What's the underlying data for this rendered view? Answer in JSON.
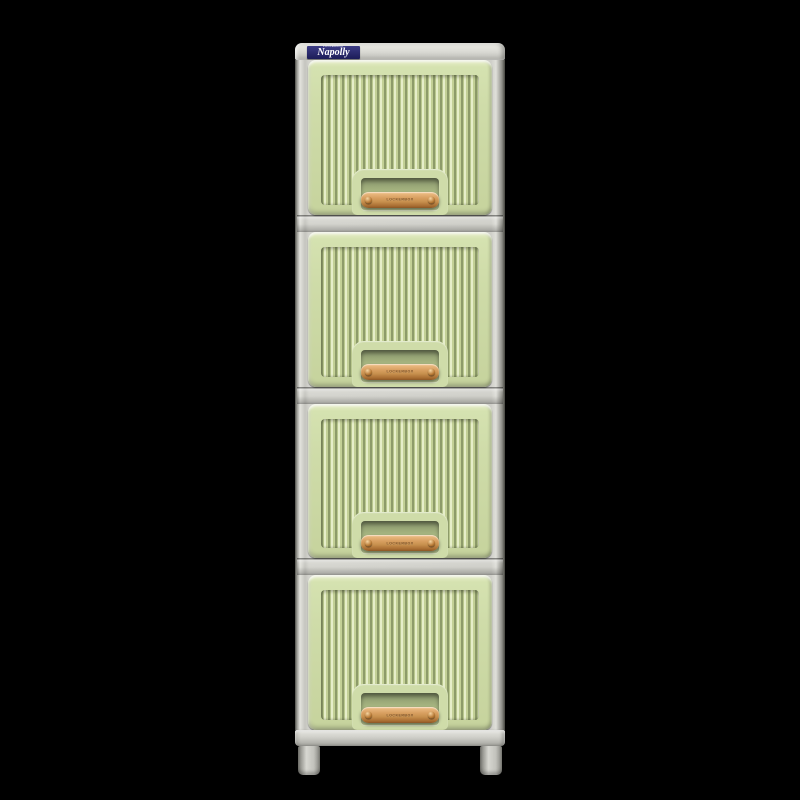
{
  "scene": {
    "background_color": "#000000",
    "subject": "Napolly four-drawer plastic stacking storage cabinet product photo"
  },
  "cabinet": {
    "brand_label": {
      "sub_text": "LOCKERBOX",
      "brand_text": "Napolly",
      "bg_color": "#23236b",
      "text_color": "#ffffff"
    },
    "drawer_count": 4,
    "drawers": [
      {
        "id": "drawer-1",
        "handle_engraving": "LOCKERBOX"
      },
      {
        "id": "drawer-2",
        "handle_engraving": "LOCKERBOX"
      },
      {
        "id": "drawer-3",
        "handle_engraving": "LOCKERBOX"
      },
      {
        "id": "drawer-4",
        "handle_engraving": "LOCKERBOX"
      }
    ],
    "colors": {
      "panel_green": "#cfdca9",
      "rib_shadow_green": "#8d9b69",
      "rib_highlight_green": "#e6eec9",
      "frame_gray": "#cfcfc9",
      "handle_wood": "#c8914f",
      "rivet_bronze": "#b97c38",
      "label_navy": "#23236b",
      "background": "#000000"
    }
  }
}
